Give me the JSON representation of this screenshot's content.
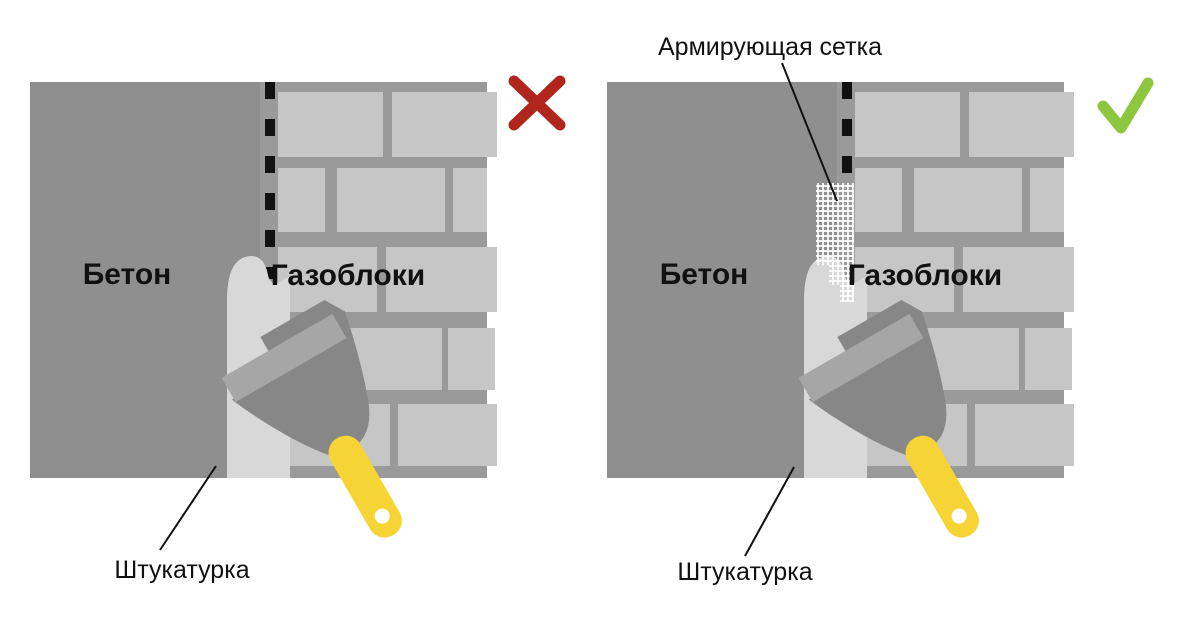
{
  "colors": {
    "cross": "#b1261c",
    "check": "#8dc63f",
    "handle": "#f6d436",
    "mesh_grid": "#ffffff",
    "concrete": "#8f8f8f",
    "brick": "#c6c6c6",
    "plaster": "#d8d8d8"
  },
  "panels": [
    {
      "name": "without-mesh",
      "verdict": "wrong",
      "verdict_icon": "cross-icon",
      "labels": {
        "concrete": "Бетон",
        "blocks": "Газоблоки",
        "plaster": "Штукатурка"
      }
    },
    {
      "name": "with-mesh",
      "verdict": "correct",
      "verdict_icon": "check-icon",
      "labels": {
        "concrete": "Бетон",
        "blocks": "Газоблоки",
        "plaster": "Штукатурка",
        "mesh": "Армирующая сетка"
      }
    }
  ]
}
